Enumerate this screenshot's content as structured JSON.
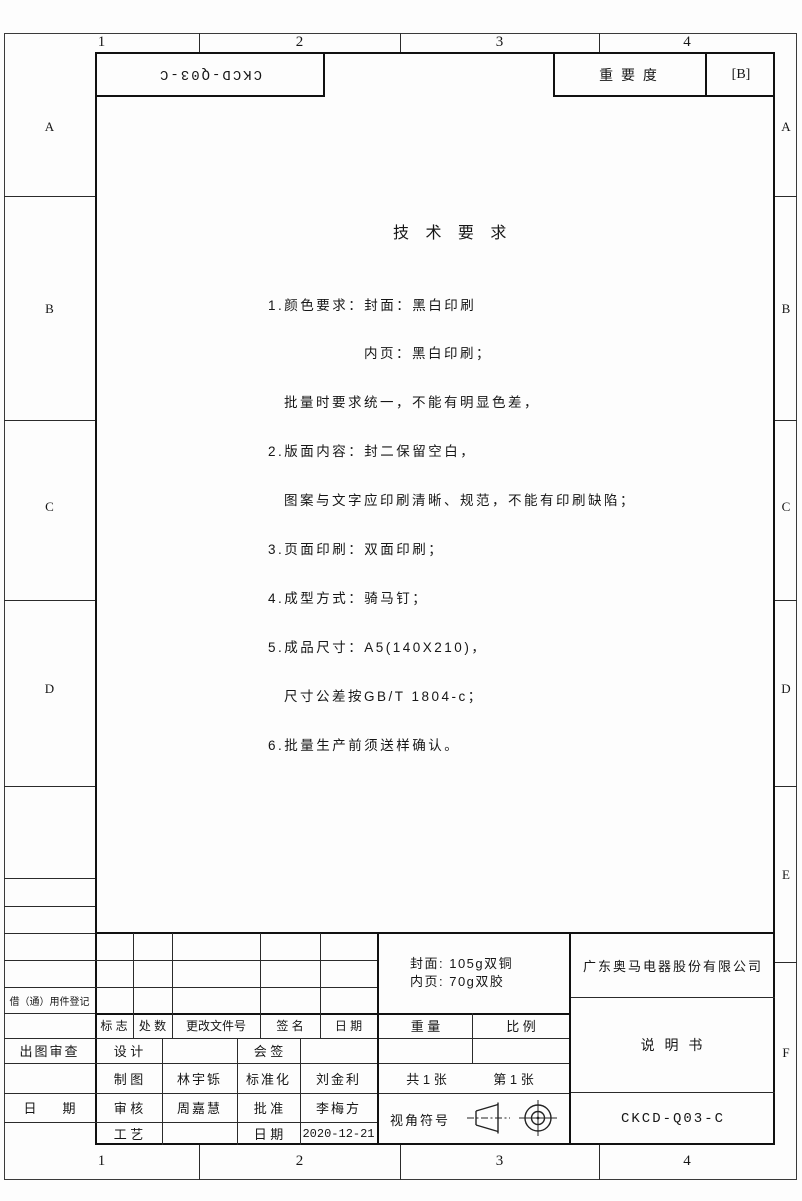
{
  "sheet": {
    "zone_numbers_top": [
      "1",
      "2",
      "3",
      "4"
    ],
    "zone_numbers_bottom": [
      "1",
      "2",
      "3",
      "4"
    ],
    "zone_letters_left": [
      "A",
      "B",
      "C",
      "D"
    ],
    "zone_letters_right": [
      "A",
      "B",
      "C",
      "D",
      "E",
      "F"
    ]
  },
  "header": {
    "inverted_code": "CKCD-Q03-C",
    "importance_label": "重 要 度",
    "importance_value": "[B]"
  },
  "tech": {
    "title": "技 术 要 求",
    "lines": [
      "1.颜色要求：封面：黑白印刷",
      "　　　　　　内页：黑白印刷；",
      "　批量时要求统一，不能有明显色差，",
      "2.版面内容：封二保留空白，",
      "　图案与文字应印刷清晰、规范，不能有印刷缺陷；",
      "3.页面印刷：双面印刷；",
      "4.成型方式：骑马钉；",
      "5.成品尺寸：A5(140X210)，",
      "　尺寸公差按GB/T 1804-c；",
      "6.批量生产前须送样确认。"
    ]
  },
  "left_margin": {
    "borrow_label": "借（通）用件登记",
    "review_label": "出图审查",
    "date_label": "日　　期"
  },
  "title_block": {
    "rev_headers": [
      "标 志",
      "处 数",
      "更改文件号",
      "签 名",
      "日 期"
    ],
    "paper_line1": "封面: 105g双铜",
    "paper_line2": "内页: 70g双胶",
    "weight_label": "重 量",
    "scale_label": "比 例",
    "rows": [
      {
        "c1": "设 计",
        "c2": "",
        "c3": "会 签",
        "c4": ""
      },
      {
        "c1": "制 图",
        "c2": "林宇铄",
        "c3": "标准化",
        "c4": "刘金利"
      },
      {
        "c1": "审 核",
        "c2": "周嘉慧",
        "c3": "批 准",
        "c4": "李梅方"
      },
      {
        "c1": "工 艺",
        "c2": "",
        "c3": "日 期",
        "c4": "2020-12-21"
      }
    ],
    "sheets_total": "共 1 张",
    "sheet_number": "第 1 张",
    "view_symbol_label": "视角符号",
    "company": "广东奥马电器股份有限公司",
    "doc_title": "说 明 书",
    "doc_code": "CKCD-Q03-C"
  }
}
